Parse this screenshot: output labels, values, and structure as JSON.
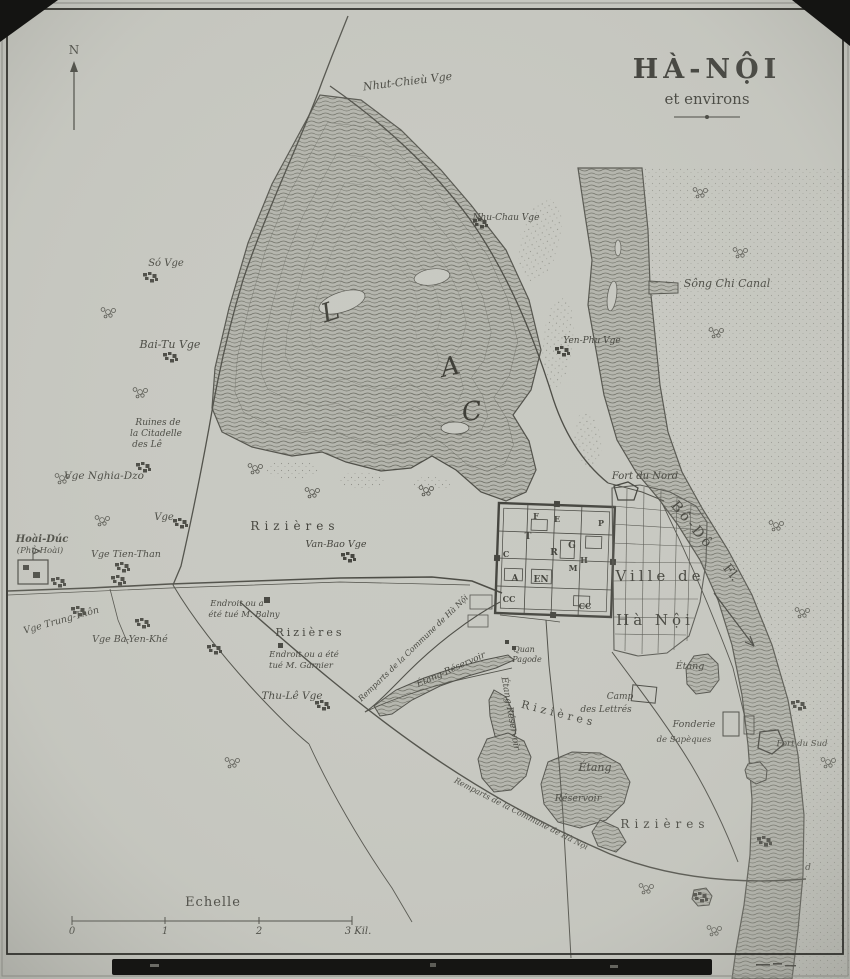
{
  "title": {
    "main": "HÀ-NỘI",
    "sub": "et environs"
  },
  "compass": {
    "label": "N"
  },
  "scale": {
    "title": "Echelle",
    "tick0": "0",
    "tick1": "1",
    "tick2": "2",
    "tick3": "3 Kil."
  },
  "labels": [
    {
      "name": "label-nhut-chieu",
      "text": "Nhut-Chieù Vge",
      "x": 408,
      "y": 85,
      "size": 11,
      "rot": -7
    },
    {
      "name": "label-nhu-chau",
      "text": "Nhu-Chau Vge",
      "x": 506,
      "y": 220,
      "size": 9
    },
    {
      "name": "label-song-chi-canal",
      "text": "Sông Chi Canal",
      "x": 727,
      "y": 287,
      "size": 11
    },
    {
      "name": "label-so-vge",
      "text": "Só Vge",
      "x": 166,
      "y": 266,
      "size": 10
    },
    {
      "name": "label-bai-tu",
      "text": "Bai-Tu Vge",
      "x": 170,
      "y": 348,
      "size": 11
    },
    {
      "name": "label-yen-phu",
      "text": "Yen-Phu Vge",
      "x": 592,
      "y": 343,
      "size": 9
    },
    {
      "name": "label-ruines-1",
      "text": "Ruines de",
      "x": 158,
      "y": 425,
      "size": 9
    },
    {
      "name": "label-ruines-2",
      "text": "la Citadelle",
      "x": 156,
      "y": 436,
      "size": 9
    },
    {
      "name": "label-ruines-3",
      "text": "des Lê",
      "x": 147,
      "y": 447,
      "size": 9
    },
    {
      "name": "label-nghia-dzo",
      "text": "Vge Nghia-Dzo",
      "x": 104,
      "y": 479,
      "size": 10.5
    },
    {
      "name": "label-vge",
      "text": "Vge",
      "x": 164,
      "y": 520,
      "size": 10
    },
    {
      "name": "label-hoai-duc",
      "text": "Hoài-Dúc",
      "x": 42,
      "y": 542,
      "size": 10,
      "bold": true
    },
    {
      "name": "label-phu-hoai",
      "text": "(Phủ-Hoài)",
      "x": 40,
      "y": 553,
      "size": 8.5
    },
    {
      "name": "label-tien-than",
      "text": "Vge Tien-Than",
      "x": 126,
      "y": 557,
      "size": 9.5
    },
    {
      "name": "label-rizieres-nw",
      "text": "Rizières",
      "x": 295,
      "y": 530,
      "size": 12,
      "spacing": 5,
      "upright": true
    },
    {
      "name": "label-van-bao",
      "text": "Van-Bao Vge",
      "x": 336,
      "y": 547,
      "size": 9.5
    },
    {
      "name": "label-balny-1",
      "text": "Endroit ou a",
      "x": 237,
      "y": 606,
      "size": 8.5
    },
    {
      "name": "label-balny-2",
      "text": "été tué M. Balny",
      "x": 244,
      "y": 617,
      "size": 8.5
    },
    {
      "name": "label-trung-thon",
      "text": "Vge Trung-Thôn",
      "x": 62,
      "y": 623,
      "size": 9.5,
      "rot": -16
    },
    {
      "name": "label-ba-yen-khe",
      "text": "Vge Ba-Yen-Khé",
      "x": 130,
      "y": 642,
      "size": 9.5
    },
    {
      "name": "label-rizieres-w",
      "text": "Rizières",
      "x": 310,
      "y": 636,
      "size": 11,
      "spacing": 3,
      "upright": true
    },
    {
      "name": "label-garnier-1",
      "text": "Endroit ou a été",
      "x": 304,
      "y": 657,
      "size": 8.5
    },
    {
      "name": "label-garnier-2",
      "text": "tué M. Garnier",
      "x": 301,
      "y": 668,
      "size": 8.5
    },
    {
      "name": "label-thu-le",
      "text": "Thu-Lê Vge",
      "x": 292,
      "y": 699,
      "size": 10.5
    },
    {
      "name": "label-fort-du-nord",
      "text": "Fort du Nord",
      "x": 645,
      "y": 479,
      "size": 10
    },
    {
      "name": "label-bo-do",
      "text": "Bô-Dô",
      "x": 689,
      "y": 528,
      "size": 14,
      "rot": 50,
      "spacing": 3,
      "upright": true
    },
    {
      "name": "label-fleuve",
      "text": "Fl.",
      "x": 728,
      "y": 575,
      "size": 13,
      "rot": 52,
      "upright": true
    },
    {
      "name": "label-ville-de",
      "text": "Ville de",
      "x": 660,
      "y": 581,
      "size": 15,
      "spacing": 4,
      "upright": true
    },
    {
      "name": "label-ha-noi-city",
      "text": "Hà Nội",
      "x": 655,
      "y": 625,
      "size": 15,
      "spacing": 4,
      "upright": true
    },
    {
      "name": "label-quan-pagode-1",
      "text": "Quan",
      "x": 524,
      "y": 652,
      "size": 8
    },
    {
      "name": "label-quan-pagode-2",
      "text": "Pagode",
      "x": 527,
      "y": 662,
      "size": 8
    },
    {
      "name": "label-etang-reservoir-1",
      "text": "Étang-Réservoir",
      "x": 452,
      "y": 672,
      "size": 9,
      "rot": -24
    },
    {
      "name": "label-etang-reservoir-2",
      "text": "Étang-Réservoir",
      "x": 508,
      "y": 714,
      "size": 9,
      "rot": 80
    },
    {
      "name": "label-remparts-1",
      "text": "Remparts de la Commune de Hà Nội",
      "x": 415,
      "y": 650,
      "size": 8,
      "rot": -44
    },
    {
      "name": "label-remparts-2",
      "text": "Remparts de la Commune de Hà Nội",
      "x": 520,
      "y": 816,
      "size": 8,
      "rot": 27
    },
    {
      "name": "label-camp-1",
      "text": "Camp",
      "x": 620,
      "y": 699,
      "size": 9
    },
    {
      "name": "label-camp-2",
      "text": "des Lettrés",
      "x": 606,
      "y": 712,
      "size": 9
    },
    {
      "name": "label-etang-fort",
      "text": "Étang",
      "x": 690,
      "y": 669,
      "size": 9.5
    },
    {
      "name": "label-fonderie-1",
      "text": "Fonderie",
      "x": 694,
      "y": 727,
      "size": 9.5
    },
    {
      "name": "label-fonderie-2",
      "text": "de Sapèques",
      "x": 684,
      "y": 742,
      "size": 8.5
    },
    {
      "name": "label-fort-du-sud",
      "text": "Fort du Sud",
      "x": 802,
      "y": 746,
      "size": 8.5
    },
    {
      "name": "label-rizieres-se",
      "text": "Rizières",
      "x": 558,
      "y": 717,
      "size": 11,
      "rot": 14,
      "spacing": 4,
      "upright": true
    },
    {
      "name": "label-etang-big",
      "text": "Étang",
      "x": 595,
      "y": 771,
      "size": 11
    },
    {
      "name": "label-reservoir",
      "text": "Réservoir",
      "x": 578,
      "y": 801,
      "size": 9.5
    },
    {
      "name": "label-rizieres-s",
      "text": "Rizières",
      "x": 665,
      "y": 828,
      "size": 12,
      "spacing": 5,
      "upright": true
    },
    {
      "name": "label-d-point",
      "text": "d",
      "x": 808,
      "y": 870,
      "size": 9
    },
    {
      "name": "label-lac-l",
      "text": "L",
      "x": 333,
      "y": 320,
      "size": 26,
      "rot": -18
    },
    {
      "name": "label-lac-a",
      "text": "A",
      "x": 452,
      "y": 375,
      "size": 26,
      "rot": -12
    },
    {
      "name": "label-lac-c",
      "text": "C",
      "x": 473,
      "y": 420,
      "size": 26,
      "rot": -8
    },
    {
      "name": "label-citadel-f",
      "text": "F",
      "x": 536,
      "y": 519,
      "size": 8,
      "upright": true,
      "bold": true
    },
    {
      "name": "label-citadel-e",
      "text": "E",
      "x": 557,
      "y": 522,
      "size": 8,
      "upright": true,
      "bold": true
    },
    {
      "name": "label-citadel-p",
      "text": "P",
      "x": 601,
      "y": 526,
      "size": 8,
      "upright": true,
      "bold": true
    },
    {
      "name": "label-citadel-t",
      "text": "T",
      "x": 528,
      "y": 539,
      "size": 9,
      "upright": true,
      "bold": true
    },
    {
      "name": "label-citadel-c1",
      "text": "C",
      "x": 506,
      "y": 557,
      "size": 8,
      "upright": true,
      "bold": true
    },
    {
      "name": "label-citadel-r",
      "text": "R",
      "x": 554,
      "y": 555,
      "size": 9,
      "upright": true,
      "bold": true
    },
    {
      "name": "label-citadel-g",
      "text": "G",
      "x": 572,
      "y": 548,
      "size": 9,
      "upright": true,
      "bold": true
    },
    {
      "name": "label-citadel-h",
      "text": "H",
      "x": 584,
      "y": 563,
      "size": 8,
      "upright": true,
      "bold": true
    },
    {
      "name": "label-citadel-m",
      "text": "M",
      "x": 573,
      "y": 571,
      "size": 8,
      "upright": true,
      "bold": true
    },
    {
      "name": "label-citadel-a",
      "text": "A",
      "x": 515,
      "y": 581,
      "size": 9,
      "upright": true,
      "bold": true
    },
    {
      "name": "label-citadel-en",
      "text": "EN",
      "x": 541,
      "y": 582,
      "size": 9,
      "upright": true,
      "bold": true
    },
    {
      "name": "label-citadel-cc1",
      "text": "CC",
      "x": 509,
      "y": 602,
      "size": 8,
      "upright": true,
      "bold": true
    },
    {
      "name": "label-citadel-cc2",
      "text": "CC",
      "x": 585,
      "y": 609,
      "size": 8,
      "upright": true,
      "bold": true
    }
  ]
}
